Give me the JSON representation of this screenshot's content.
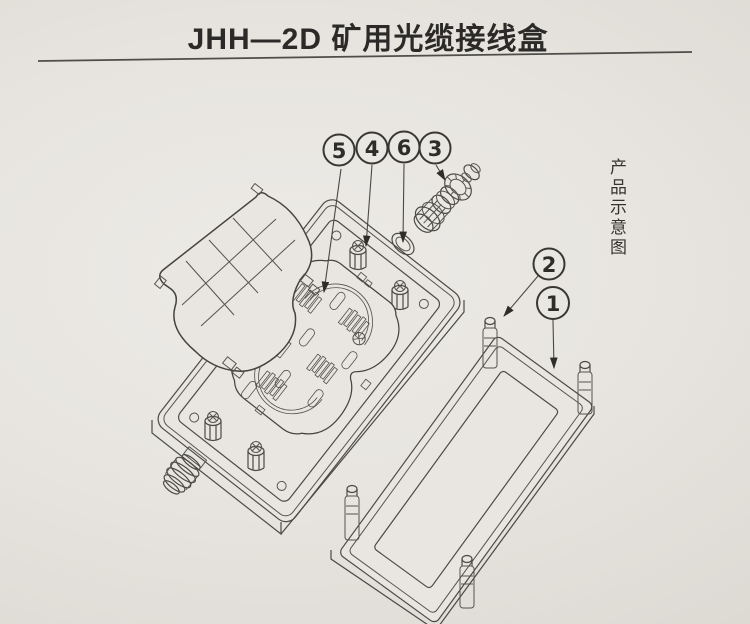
{
  "title": {
    "text": "JHH—2D 矿用光缆接线盒"
  },
  "side_label": {
    "text": "产品示意图"
  },
  "callouts": {
    "top": [
      {
        "num": "5"
      },
      {
        "num": "4"
      },
      {
        "num": "6"
      },
      {
        "num": "3"
      }
    ],
    "right": [
      {
        "num": "2"
      },
      {
        "num": "1"
      }
    ]
  },
  "colors": {
    "paper_light": "#edebe7",
    "paper_dark": "#d5d1ca",
    "line": "#4c4a46",
    "ink": "#2b2a28"
  }
}
